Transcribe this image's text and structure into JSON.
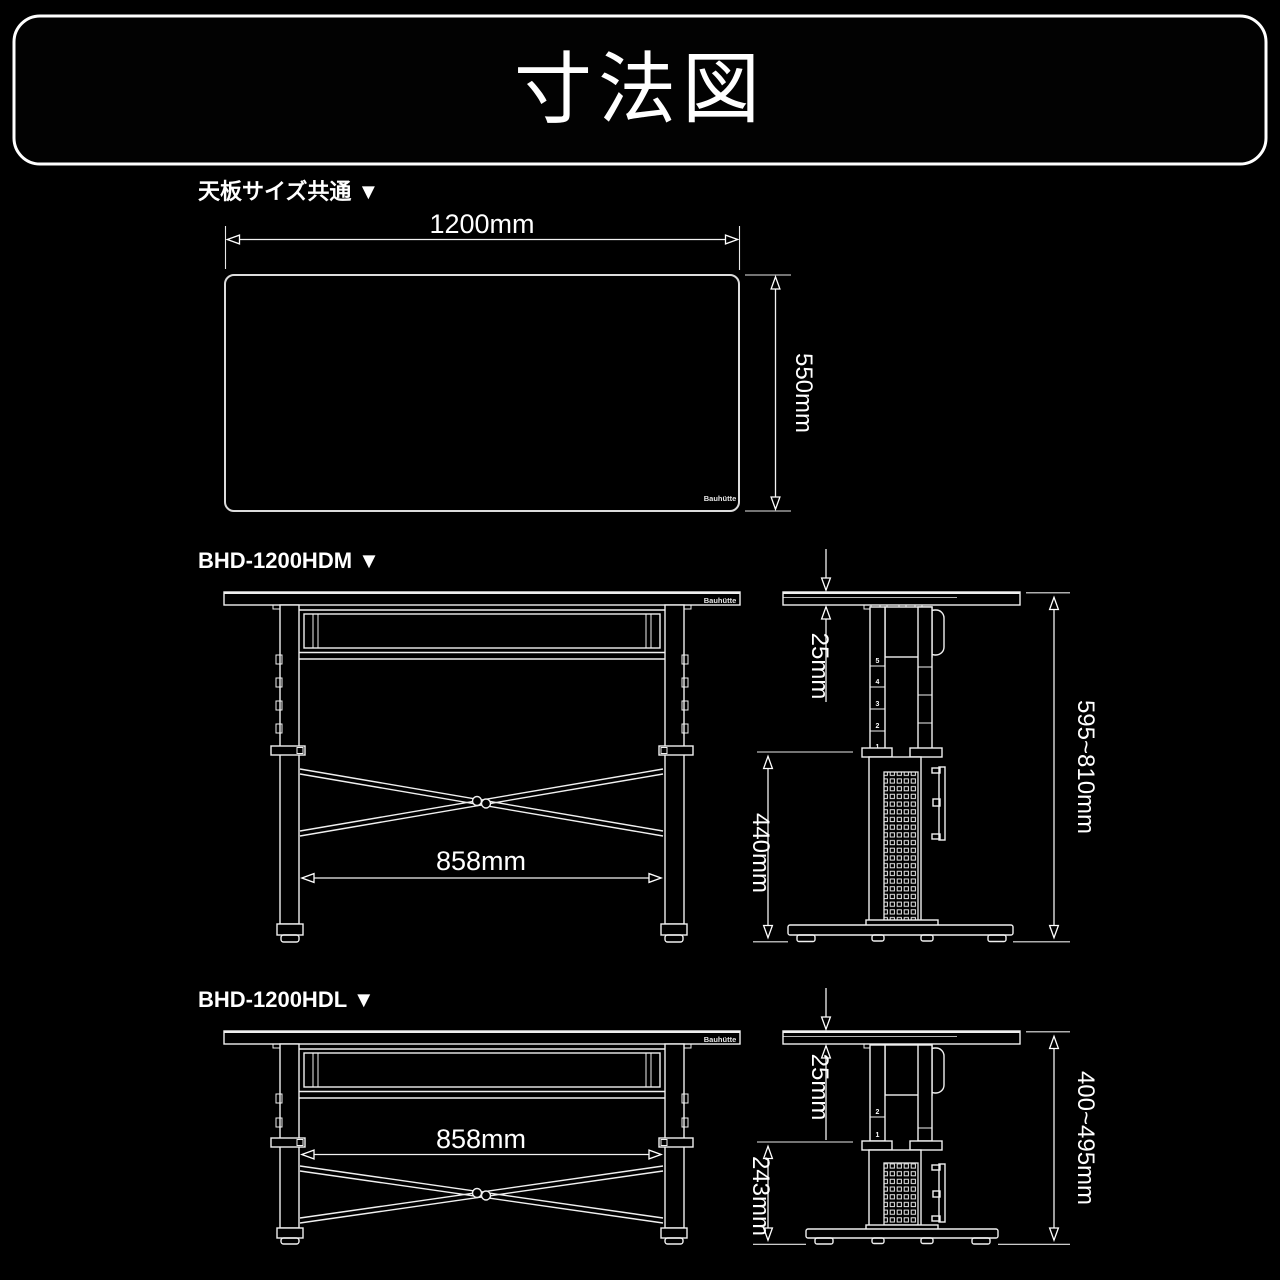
{
  "title": "寸法図",
  "brand_logo": "Bauhütte",
  "top_section": {
    "label": "天板サイズ共通 ▼",
    "width": "1200mm",
    "depth": "550mm"
  },
  "hdm_section": {
    "label": "BHD-1200HDM ▼",
    "inner_width": "858mm",
    "top_thickness": "25mm",
    "under_clearance": "440mm",
    "height_range": "595~810mm",
    "rail_numbers": [
      "5",
      "4",
      "3",
      "2",
      "1"
    ]
  },
  "hdl_section": {
    "label": "BHD-1200HDL ▼",
    "inner_width": "858mm",
    "top_thickness": "25mm",
    "under_clearance": "243mm",
    "height_range": "400~495mm",
    "rail_numbers": [
      "2",
      "1"
    ]
  },
  "colors": {
    "background": "#000000",
    "line": "#f0f0f0",
    "text": "#ffffff"
  }
}
